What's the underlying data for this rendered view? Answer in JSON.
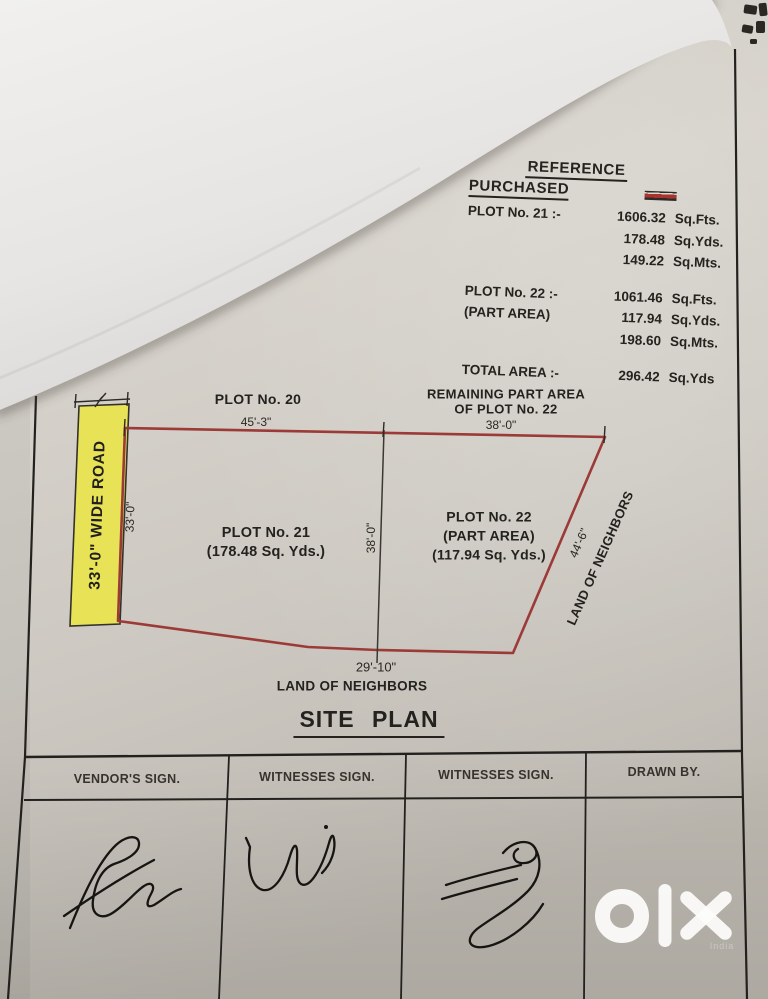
{
  "reference": {
    "title": "REFERENCE",
    "subtitle": "PURCHASED",
    "legend_swatch": "purchased-area-red-swatch",
    "rows": [
      {
        "label": "PLOT  No. 21 :-",
        "value": "1606.32",
        "unit": "Sq.Fts."
      },
      {
        "label": "",
        "value": "178.48",
        "unit": "Sq.Yds."
      },
      {
        "label": "",
        "value": "149.22",
        "unit": "Sq.Mts."
      },
      {
        "label": "PLOT  No. 22 :-",
        "value": "1061.46",
        "unit": "Sq.Fts."
      },
      {
        "label": "(PART AREA)",
        "value": "117.94",
        "unit": "Sq.Yds."
      },
      {
        "label": "",
        "value": "198.60",
        "unit": "Sq.Mts."
      },
      {
        "label": "TOTAL AREA :-",
        "value": "296.42",
        "unit": "Sq.Yds"
      }
    ]
  },
  "site_plan": {
    "title": "SITE PLAN",
    "top_labels": {
      "plot20": "PLOT No. 20",
      "remaining_line1": "REMAINING PART AREA",
      "remaining_line2": "OF PLOT No. 22"
    },
    "dimensions": {
      "top_left": "45'-3\"",
      "top_right": "38'-0\"",
      "left": "33'-0\"",
      "middle": "38'-0\"",
      "right": "44'-6\"",
      "bottom": "29'-10\""
    },
    "road_label": "33'-0\" WIDE ROAD",
    "plot21": {
      "line1": "PLOT No. 21",
      "line2": "(178.48 Sq. Yds.)"
    },
    "plot22": {
      "line1": "PLOT No. 22",
      "line2": "(PART AREA)",
      "line3": "(117.94 Sq. Yds.)"
    },
    "neighbors_right": "LAND OF NEIGHBORS",
    "neighbors_bottom": "LAND OF NEIGHBORS"
  },
  "signature_table": {
    "headers": [
      "VENDOR'S SIGN.",
      "WITNESSES  SIGN.",
      "WITNESSES  SIGN.",
      "DRAWN BY."
    ]
  },
  "watermark": {
    "brand": "olx",
    "sub": "India"
  },
  "colors": {
    "plot_outline": "#9c3a38",
    "road_fill": "#e8e257",
    "paper": "#cfcbc4",
    "ink": "#23211e",
    "swatch_red": "#a83430"
  }
}
